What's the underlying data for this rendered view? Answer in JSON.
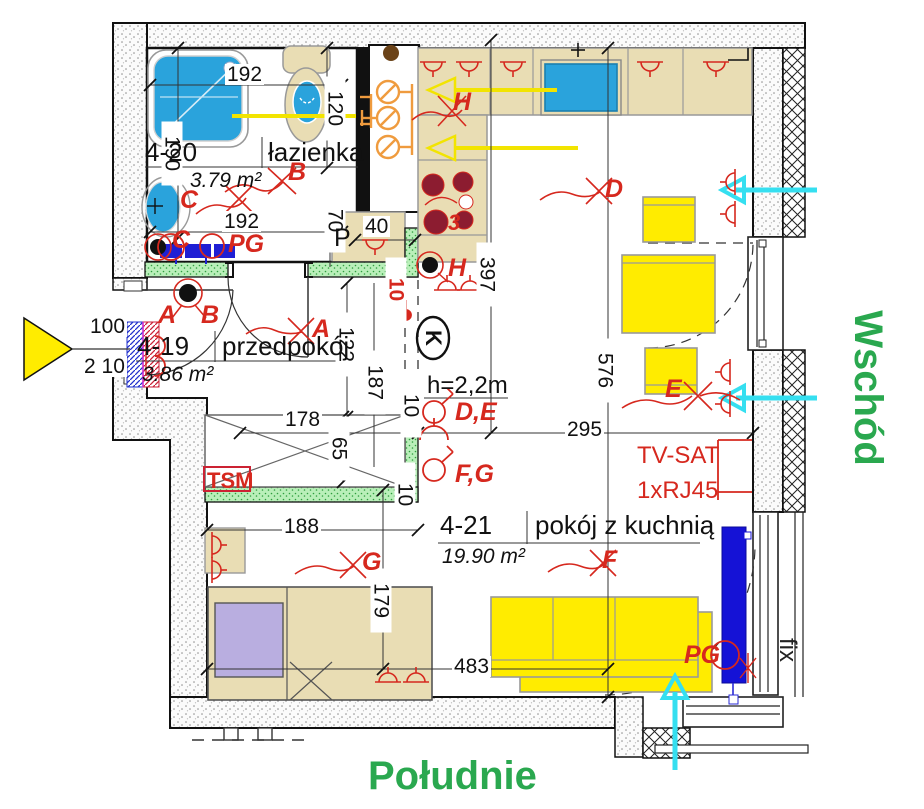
{
  "colors": {
    "annotation_red": "#d6281e",
    "compass_green": "#2aa84f",
    "furniture_yellow": "#ffec00",
    "fixture_blue": "#2aa3dc",
    "deep_blue": "#1512d6",
    "counter_beige": "#e9ddb4",
    "wall_green": "#b9efb9",
    "cyan_arrow": "#35dff0",
    "pillow_purple": "#b9aee0",
    "burner_maroon": "#8c1c30",
    "shaft_orange": "#ef9b3e"
  },
  "compass": {
    "east": "Wschód",
    "south": "Południe"
  },
  "rooms": [
    {
      "id": "4-20",
      "name": "łazienka",
      "area": "3.79 m²"
    },
    {
      "id": "4-19",
      "name": "przedpokój",
      "area": "3.86 m²"
    },
    {
      "id": "4-21",
      "name": "pokój z kuchnią",
      "area": "19.90 m²"
    }
  ],
  "dims": {
    "w192a": "192",
    "w192b": "192",
    "h190": "190",
    "h120": "120",
    "h70": "70",
    "w40": "40",
    "h397": "397",
    "h576": "576",
    "w295": "295",
    "h122": "122",
    "h187": "187",
    "w178": "178",
    "h65": "65",
    "w100": "100",
    "h210": "2 10",
    "w188": "188",
    "h179": "179",
    "w483": "483",
    "t10a": "10",
    "t10b": "10",
    "t10c": "10"
  },
  "labels": {
    "p": "P",
    "k": "K",
    "tsm": "TSM",
    "ceiling": "h=2,2m",
    "tv": "TV-SAT",
    "rj": "1xRJ45",
    "fix": "fix",
    "burners": "3"
  },
  "electric": {
    "a1": "A",
    "b1": "B",
    "a2": "A",
    "b2": "B",
    "c1": "C",
    "c2": "C",
    "pg1": "PG",
    "pg2": "PG",
    "d": "D",
    "e": "E",
    "f": "F",
    "g": "G",
    "h1": "H",
    "h2": "H",
    "de": "D,E",
    "fg": "F,G"
  }
}
